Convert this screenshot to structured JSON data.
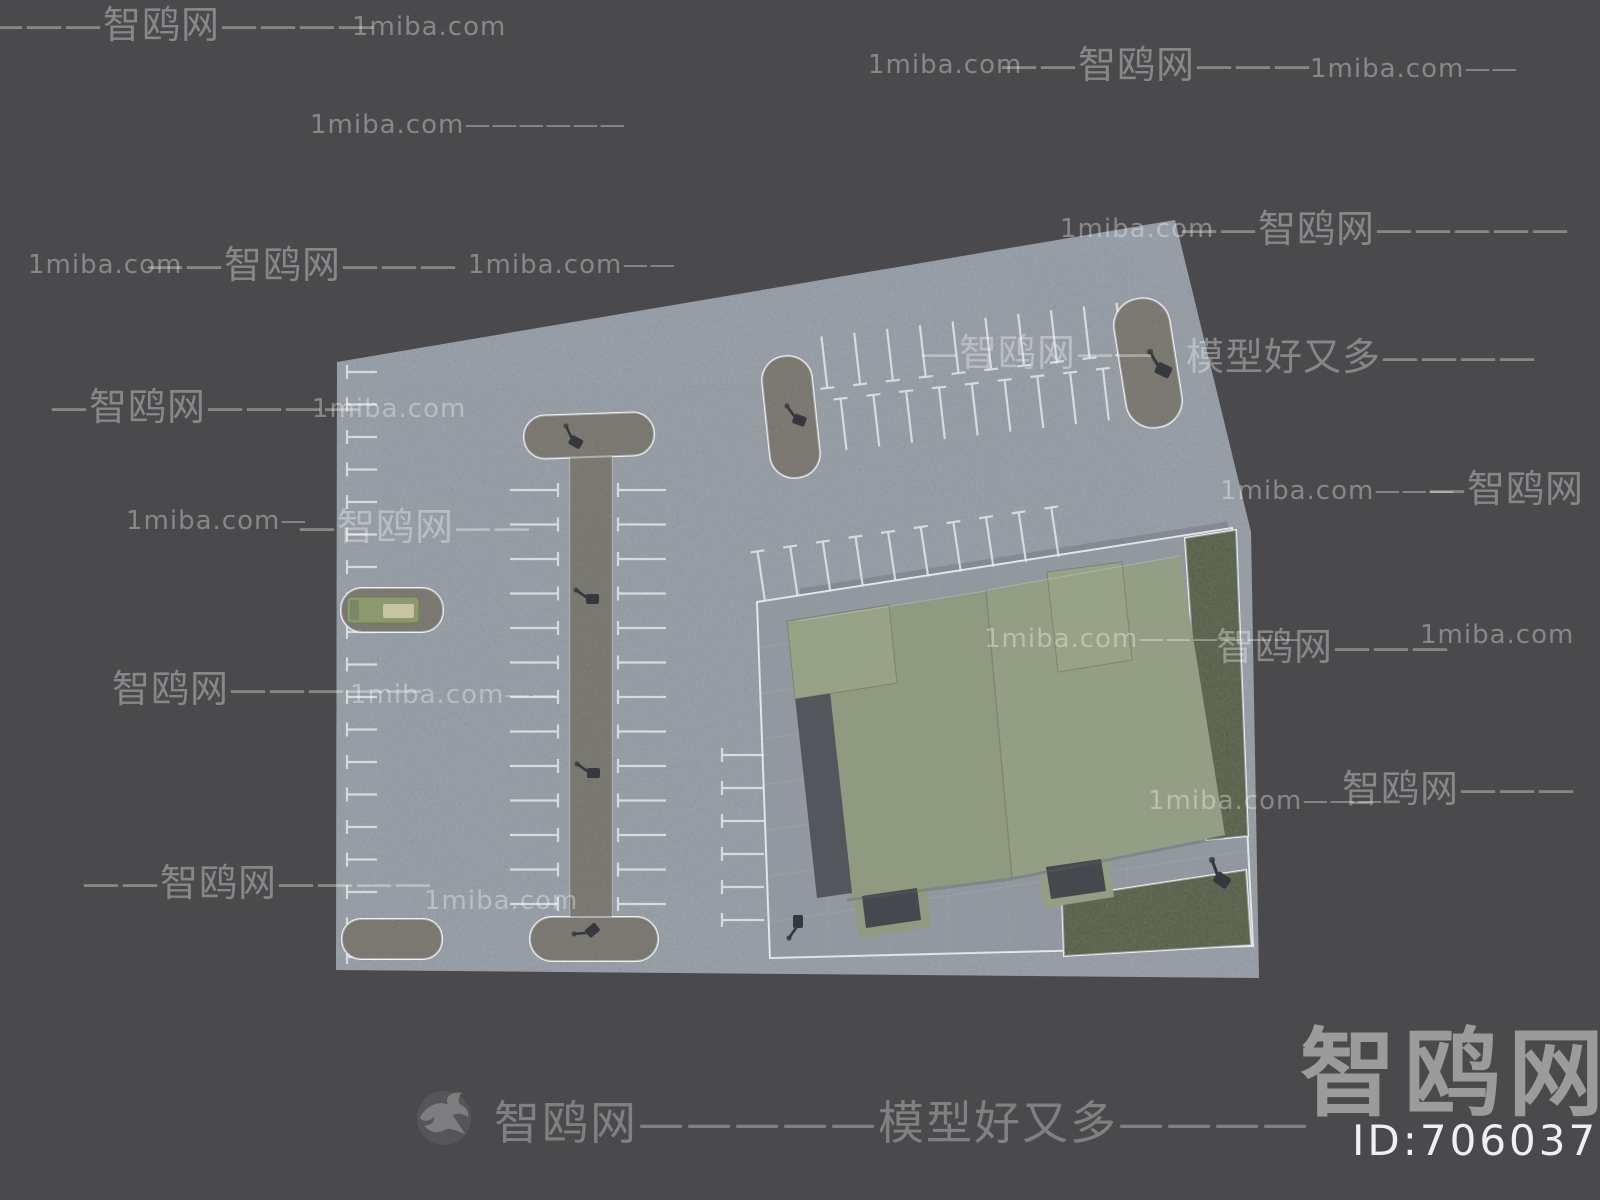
{
  "page": {
    "title": "顶视停车场与建筑 3D 模型预览",
    "background": "#4a4a4c"
  },
  "watermarks": {
    "brand": "智鸥网",
    "domain": "1miba.com",
    "slogan": "模型好又多",
    "items": [
      {
        "x": -14,
        "y": 6,
        "fs": 38,
        "text": "———智鸥网————"
      },
      {
        "x": 352,
        "y": 14,
        "fs": 26,
        "text": "1miba.com"
      },
      {
        "x": 868,
        "y": 52,
        "fs": 26,
        "text": "1miba.com"
      },
      {
        "x": 1000,
        "y": 46,
        "fs": 38,
        "text": "——智鸥网———"
      },
      {
        "x": 1310,
        "y": 56,
        "fs": 26,
        "text": "1miba.com——"
      },
      {
        "x": 310,
        "y": 112,
        "fs": 26,
        "text": "1miba.com——————"
      },
      {
        "x": 1060,
        "y": 216,
        "fs": 26,
        "text": "1miba.com"
      },
      {
        "x": 1180,
        "y": 210,
        "fs": 38,
        "text": "——智鸥网—————"
      },
      {
        "x": 28,
        "y": 252,
        "fs": 26,
        "text": "1miba.com"
      },
      {
        "x": 146,
        "y": 246,
        "fs": 38,
        "text": "——智鸥网———"
      },
      {
        "x": 468,
        "y": 252,
        "fs": 26,
        "text": "1miba.com——"
      },
      {
        "x": 920,
        "y": 334,
        "fs": 38,
        "text": "—智鸥网——"
      },
      {
        "x": 1186,
        "y": 338,
        "fs": 38,
        "text": "模型好又多————"
      },
      {
        "x": 50,
        "y": 388,
        "fs": 38,
        "text": "—智鸥网————"
      },
      {
        "x": 312,
        "y": 396,
        "fs": 26,
        "text": "1miba.com"
      },
      {
        "x": 126,
        "y": 508,
        "fs": 26,
        "text": "1miba.com—"
      },
      {
        "x": 298,
        "y": 508,
        "fs": 38,
        "text": "—智鸥网——"
      },
      {
        "x": 1220,
        "y": 478,
        "fs": 26,
        "text": "1miba.com———"
      },
      {
        "x": 1428,
        "y": 470,
        "fs": 38,
        "text": "—智鸥网"
      },
      {
        "x": 984,
        "y": 626,
        "fs": 26,
        "text": "1miba.com——————"
      },
      {
        "x": 1216,
        "y": 628,
        "fs": 38,
        "text": "智鸥网———"
      },
      {
        "x": 1420,
        "y": 622,
        "fs": 26,
        "text": "1miba.com"
      },
      {
        "x": 112,
        "y": 670,
        "fs": 38,
        "text": "智鸥网—————"
      },
      {
        "x": 350,
        "y": 682,
        "fs": 26,
        "text": "1miba.com——"
      },
      {
        "x": 1148,
        "y": 788,
        "fs": 26,
        "text": "1miba.com———"
      },
      {
        "x": 1342,
        "y": 770,
        "fs": 38,
        "text": "智鸥网———"
      },
      {
        "x": 82,
        "y": 864,
        "fs": 38,
        "text": "——智鸥网————"
      },
      {
        "x": 424,
        "y": 888,
        "fs": 26,
        "text": "1miba.com"
      }
    ],
    "footer": {
      "x": 494,
      "y": 1100,
      "fs": 46,
      "text": "智鸥网—————模型好又多————"
    },
    "logo": {
      "x": 1300,
      "y": 1026,
      "fs": 96,
      "text": "智鸥网"
    },
    "id_label": {
      "x": 1352,
      "y": 1120,
      "fs": 42,
      "text": "ID:706037048"
    },
    "bird": {
      "x": 414,
      "y": 1086,
      "size": 62
    }
  },
  "site": {
    "colors": {
      "lot": "#9aa2ac",
      "plaza": "#9ba2a9",
      "plaza_border": "#e9ebee",
      "curb": "#767c85",
      "grass": "#7f8c67",
      "grass_border": "#edf0f1",
      "gravel": "#a9a79d",
      "island_border": "#eef0f2",
      "stall_line": "#e6e9ec",
      "roof_left": "#8f9a80",
      "roof_right": "#939e84",
      "roof_bump": "#98a287",
      "roof_dark": "#53575d",
      "canopy_dark": "#45484c",
      "seam": "#7b8468",
      "car_body": "#8c996f",
      "car_window": "#c8c3a2",
      "car_tail": "#798766",
      "lamp": "#35383c",
      "shadow": "#5d636b"
    },
    "lot_points": "337,362 1175,220 1251,532 1259,978 336,970",
    "plaza_points": "757,602 1232,528 1253,946 770,958",
    "curb": {
      "x1": 800,
      "y1": 592,
      "x2": 1228,
      "y2": 525
    },
    "grass": [
      {
        "name": "grass-strip-east",
        "points": "1185,538 1236,530 1248,836 1206,840"
      },
      {
        "name": "grass-patch-south",
        "points": "1062,898 1246,870 1251,945 1064,956"
      }
    ],
    "islands": [
      {
        "name": "median-strip",
        "x": 570,
        "y": 450,
        "w": 42,
        "h": 472,
        "rx": 3,
        "rot": 0,
        "faint": true
      },
      {
        "name": "island-north-left",
        "x": 766,
        "y": 356,
        "w": 50,
        "h": 122,
        "rx": 24,
        "rot": -6
      },
      {
        "name": "island-north-right",
        "x": 1120,
        "y": 298,
        "w": 56,
        "h": 130,
        "rx": 27,
        "rot": -9
      },
      {
        "name": "median-cap-top",
        "x": 524,
        "y": 414,
        "w": 130,
        "h": 43,
        "rx": 21,
        "rot": -2
      },
      {
        "name": "median-cap-bottom",
        "x": 530,
        "y": 917,
        "w": 128,
        "h": 44,
        "rx": 22,
        "rot": 0
      },
      {
        "name": "island-south-west",
        "x": 342,
        "y": 919,
        "w": 100,
        "h": 40,
        "rx": 19,
        "rot": 0
      },
      {
        "name": "car-pad",
        "x": 341,
        "y": 588,
        "w": 102,
        "h": 44,
        "rx": 21,
        "rot": 0
      }
    ],
    "combs": [
      {
        "name": "west-edge-stalls",
        "ox": 347,
        "oy": 372,
        "angle": 0,
        "dir": "h",
        "sx": 0,
        "sy": 0,
        "len": 30,
        "pitch": 32.5,
        "count": 19,
        "tick": "start",
        "tickLen": 14
      },
      {
        "name": "median-west-stalls",
        "ox": 510,
        "oy": 490,
        "angle": 0,
        "dir": "h",
        "sx": 0,
        "sy": 0,
        "len": 48,
        "pitch": 34.5,
        "count": 13,
        "tick": "end",
        "tickLen": 14
      },
      {
        "name": "median-east-stalls",
        "ox": 618,
        "oy": 490,
        "angle": 0,
        "dir": "h",
        "sx": 0,
        "sy": 0,
        "len": 48,
        "pitch": 34.5,
        "count": 13,
        "tick": "start",
        "tickLen": 14
      },
      {
        "name": "north-row-upper",
        "ox": 828,
        "oy": 394,
        "angle": -6.5,
        "dir": "v",
        "sx": 0,
        "sy": -58,
        "len": 52,
        "pitch": 33,
        "count": 10,
        "tick": "end",
        "tickLen": 14
      },
      {
        "name": "north-row-lower",
        "ox": 828,
        "oy": 394,
        "angle": -6.5,
        "dir": "v",
        "sx": 12,
        "sy": 6,
        "len": 52,
        "pitch": 33,
        "count": 10,
        "tick": "start",
        "tickLen": 14
      },
      {
        "name": "plaza-north-stalls",
        "ox": 757,
        "oy": 602,
        "angle": -8.5,
        "dir": "v",
        "sx": 8,
        "sy": -50,
        "len": 50,
        "pitch": 33,
        "count": 10,
        "tick": "start",
        "tickLen": 14
      },
      {
        "name": "plaza-west-stalls",
        "ox": 722,
        "oy": 755,
        "angle": 0,
        "dir": "h",
        "sx": 0,
        "sy": 0,
        "len": 42,
        "pitch": 33,
        "count": 6,
        "tick": "start",
        "tickLen": 14
      }
    ],
    "building": {
      "left_slab": "797,621 986,591 1012,878 847,898",
      "dark_strip": "795,697 830,692 852,893 817,898",
      "right_slab": "987,590 1180,556 1225,835 1012,878",
      "bump_nw": "787,621 889,605 897,683 795,699",
      "bump_n": "1047,572 1122,562 1132,660 1058,672",
      "canopy1_outer": "853,890 925,879 931,927 859,938",
      "canopy1_inner": "862,896 917,888 921,920 866,928",
      "canopy2_outer": "1038,861 1108,850 1114,897 1044,908",
      "canopy2_inner": "1046,867 1101,859 1106,891 1051,899",
      "seam": {
        "x1": 986,
        "y1": 591,
        "x2": 1012,
        "y2": 878
      },
      "shadow_path": "M847,900 L1011,879 L1224,837"
    },
    "car": {
      "body": {
        "x": 347,
        "y": 597,
        "w": 72,
        "h": 26
      },
      "window": {
        "x": 383,
        "y": 604,
        "w": 31,
        "h": 14
      },
      "tail": {
        "x": 350,
        "y": 600,
        "w": 9,
        "h": 20
      }
    },
    "lamps": [
      {
        "x": 566,
        "y": 426,
        "rot": 30,
        "s": 1
      },
      {
        "x": 576,
        "y": 590,
        "rot": 0,
        "s": 1
      },
      {
        "x": 577,
        "y": 764,
        "rot": 0,
        "s": 1
      },
      {
        "x": 574,
        "y": 934,
        "rot": -40,
        "s": 1
      },
      {
        "x": 787,
        "y": 406,
        "rot": 20,
        "s": 1
      },
      {
        "x": 1150,
        "y": 352,
        "rot": 25,
        "s": 1.2
      },
      {
        "x": 789,
        "y": 938,
        "rot": -90,
        "s": 1
      },
      {
        "x": 1212,
        "y": 860,
        "rot": 35,
        "s": 1.2
      }
    ]
  }
}
